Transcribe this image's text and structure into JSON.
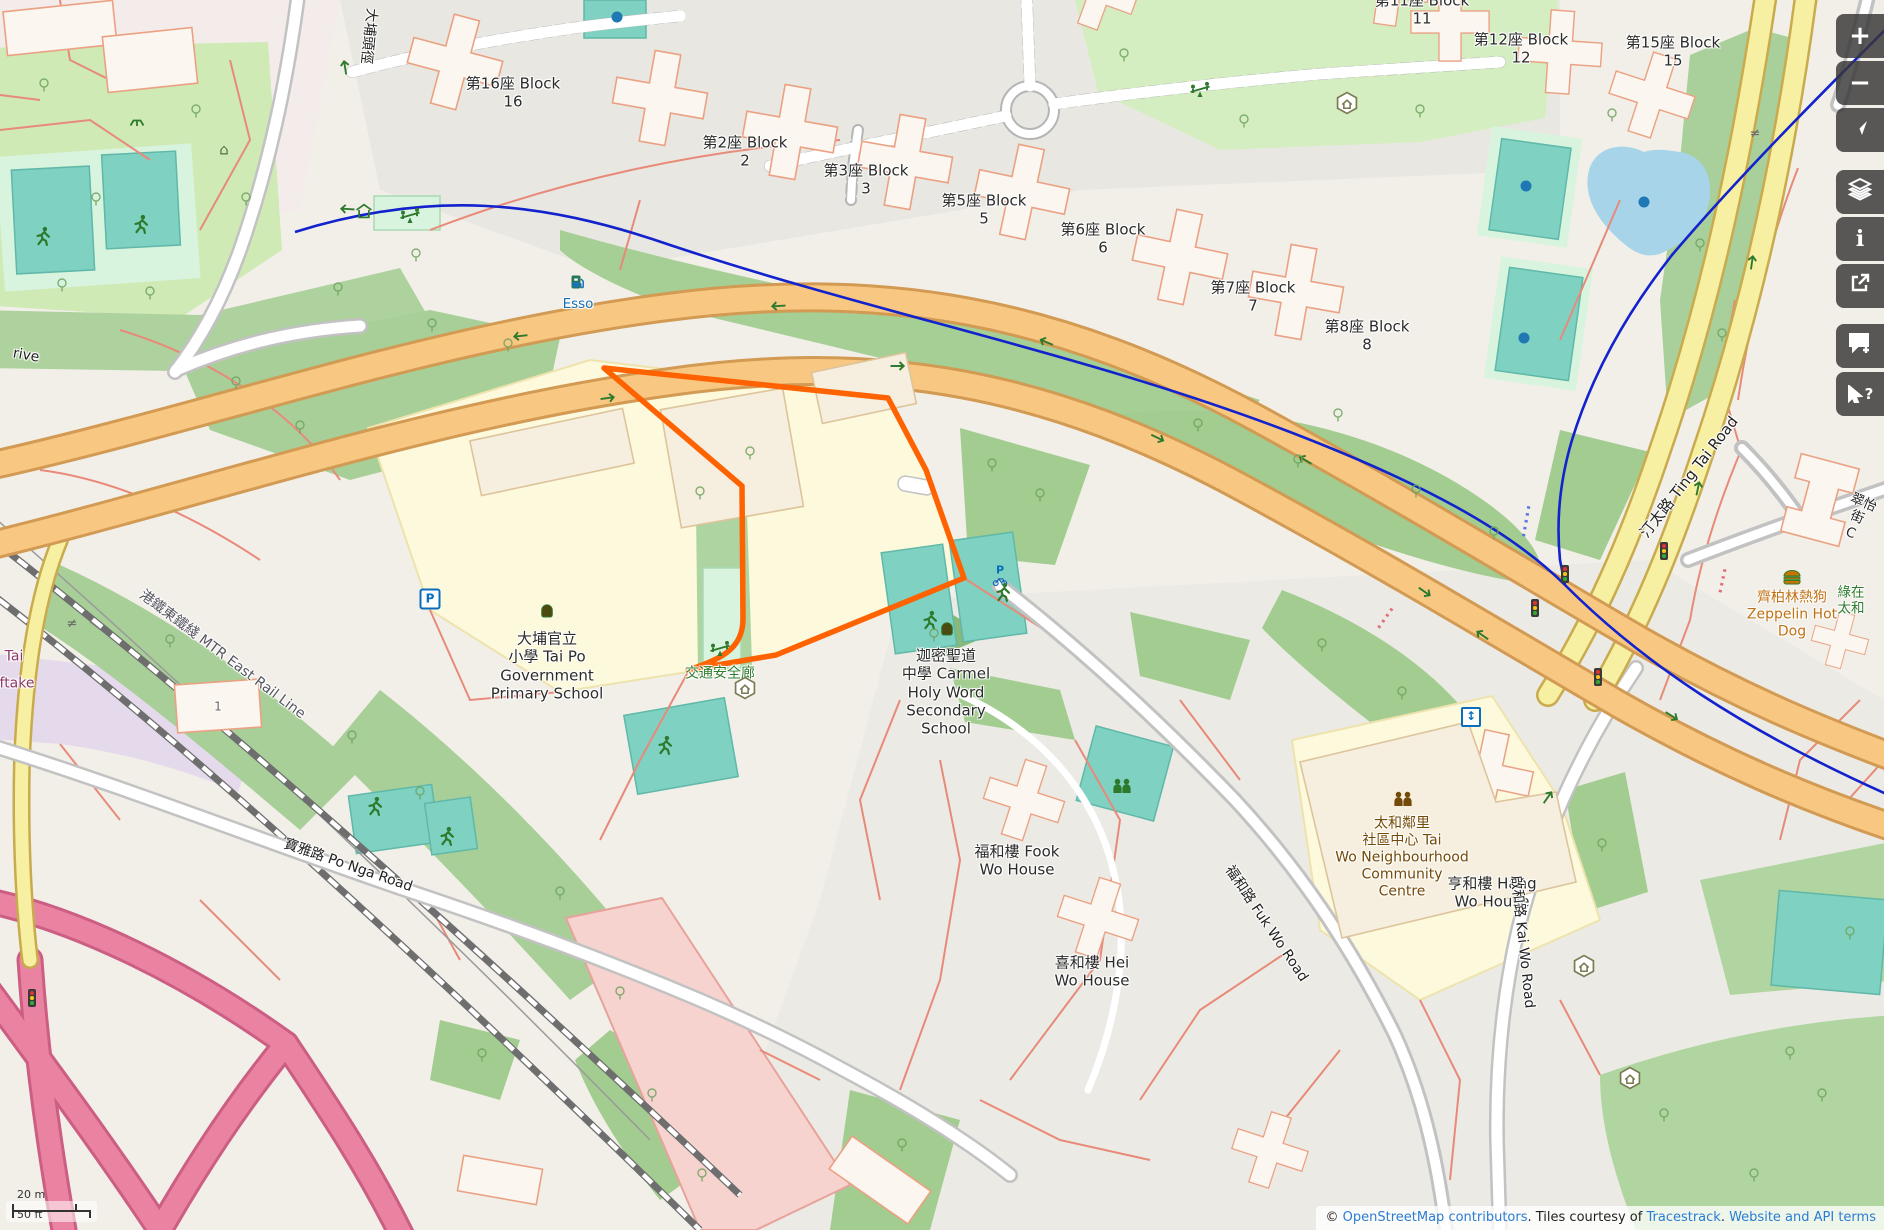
{
  "map": {
    "selection_color": "#ff6200",
    "water_color": "#aad3df",
    "trunk_road_color": "#f8c883",
    "primary_road_color": "#f7efa2"
  },
  "controls": {
    "zoom_in": {
      "label": "+"
    },
    "zoom_out": {
      "label": "−"
    },
    "show_location": {
      "label": ""
    },
    "layers": {
      "label": ""
    },
    "map_info": {
      "label": "i"
    },
    "share": {
      "label": ""
    },
    "add_note": {
      "label": ""
    },
    "query_features": {
      "label": "?"
    }
  },
  "scale_bar": {
    "metric": "20 m",
    "imperial": "50 ft"
  },
  "attribution": {
    "prefix": "© ",
    "osm_link": "OpenStreetMap contributors",
    "middle": ". Tiles courtesy of ",
    "tracestrack_link": "Tracestrack",
    "separator": ". ",
    "terms_link": "Website and API terms"
  },
  "map_labels": [
    {
      "n": "label-block-16",
      "t": "第16座 Block\n16",
      "x": 513,
      "y": 93
    },
    {
      "n": "label-block-2",
      "t": "第2座 Block\n2",
      "x": 745,
      "y": 152
    },
    {
      "n": "label-block-3",
      "t": "第3座 Block\n3",
      "x": 866,
      "y": 180
    },
    {
      "n": "label-block-5",
      "t": "第5座 Block\n5",
      "x": 984,
      "y": 210
    },
    {
      "n": "label-block-6",
      "t": "第6座 Block\n6",
      "x": 1103,
      "y": 239
    },
    {
      "n": "label-block-7",
      "t": "第7座 Block\n7",
      "x": 1253,
      "y": 297
    },
    {
      "n": "label-block-8",
      "t": "第8座 Block\n8",
      "x": 1367,
      "y": 336
    },
    {
      "n": "label-block-11",
      "t": "第11座 Block\n11",
      "x": 1422,
      "y": 10
    },
    {
      "n": "label-block-12",
      "t": "第12座 Block\n12",
      "x": 1521,
      "y": 49
    },
    {
      "n": "label-block-15",
      "t": "第15座 Block\n15",
      "x": 1673,
      "y": 52
    },
    {
      "n": "label-esso",
      "t": "Esso",
      "x": 578,
      "y": 304,
      "c": "#1471b8",
      "s": 13.5
    },
    {
      "n": "label-tai-po-primary-school",
      "t": "大埔官立\n小學 Tai Po\nGovernment\nPrimary School",
      "x": 547,
      "y": 666
    },
    {
      "n": "label-carmel-school",
      "t": "迦密聖道\n中學 Carmel\nHoly Word\nSecondary\nSchool",
      "x": 946,
      "y": 692
    },
    {
      "n": "label-road-safety-corridor",
      "t": "交通安全廊",
      "x": 720,
      "y": 674,
      "c": "#2f7d2f",
      "s": 14
    },
    {
      "n": "label-fook-wo-house",
      "t": "福和樓 Fook\nWo House",
      "x": 1017,
      "y": 861
    },
    {
      "n": "label-community-centre",
      "t": "太和鄰里\n社區中心 Tai\nWo Neighbourhood\nCommunity\nCentre",
      "x": 1402,
      "y": 858,
      "c": "#734a08",
      "s": 14
    },
    {
      "n": "label-zeppelin-hot-dog",
      "t": "齊柏林熱狗\nZeppelin Hot\nDog",
      "x": 1792,
      "y": 615,
      "c": "#c17114",
      "s": 14
    },
    {
      "n": "label-hei-wo-house",
      "t": "喜和樓 Hei\nWo House",
      "x": 1092,
      "y": 972
    },
    {
      "n": "label-hang-wo-house",
      "t": "亨和樓 Hang\nWo House",
      "x": 1492,
      "y": 893
    },
    {
      "n": "label-po-nga-road",
      "t": "寶雅路 Po Nga Road",
      "x": 348,
      "y": 866,
      "r": 19,
      "s": 14,
      "c": "#222"
    },
    {
      "n": "label-ting-tai-road",
      "t": "汀太路 Ting Tai Road",
      "x": 1689,
      "y": 477,
      "r": -52,
      "s": 15,
      "c": "#222"
    },
    {
      "n": "label-fuk-wo-road",
      "t": "福和路 Fuk Wo Road",
      "x": 1266,
      "y": 924,
      "r": 56,
      "s": 14,
      "c": "#222"
    },
    {
      "n": "label-kai-wo-road",
      "t": "啟和路 Kai Wo Road",
      "x": 1522,
      "y": 942,
      "r": 84,
      "s": 14,
      "c": "#222"
    },
    {
      "n": "label-mtr-east-rail-line",
      "t": "港鐵東鐵綫 MTR East Rail Line",
      "x": 222,
      "y": 655,
      "r": 37,
      "s": 14,
      "c": "#55555f"
    },
    {
      "n": "label-tai-po-tau-path",
      "t": "大埔頭徑",
      "x": 368,
      "y": 36,
      "r": 96,
      "s": 14,
      "c": "#222"
    },
    {
      "n": "label-drive-fragment",
      "t": "rive",
      "x": 26,
      "y": 356,
      "r": 10,
      "s": 14,
      "c": "#222"
    },
    {
      "n": "label-tai-fragment",
      "t": "Tai",
      "x": 14,
      "y": 657,
      "c": "#8b3a6a",
      "s": 14
    },
    {
      "n": "label-ftake-fragment",
      "t": "ftake",
      "x": 17,
      "y": 684,
      "c": "#8b3a6a",
      "s": 14
    },
    {
      "n": "label-tsui-yi-street",
      "t": "翠怡街 C",
      "x": 1857,
      "y": 518,
      "r": 23,
      "s": 13.5,
      "c": "#222"
    },
    {
      "n": "label-green-at-tai-wo",
      "t": "綠在太和",
      "x": 1851,
      "y": 601,
      "c": "#2f7d2f",
      "s": 13.5
    },
    {
      "n": "label-building-1",
      "t": "1",
      "x": 218,
      "y": 707,
      "s": 12,
      "c": "#666"
    }
  ],
  "map_icons": [
    {
      "t": "parking",
      "x": 430,
      "y": 599
    },
    {
      "t": "bicycle-parking",
      "x": 1000,
      "y": 576
    },
    {
      "t": "elevator",
      "x": 1471,
      "y": 717
    },
    {
      "t": "fuel",
      "x": 578,
      "y": 282
    },
    {
      "t": "school",
      "x": 547,
      "y": 611
    },
    {
      "t": "school",
      "x": 947,
      "y": 629
    },
    {
      "t": "runner",
      "x": 929,
      "y": 620
    },
    {
      "t": "runner",
      "x": 1002,
      "y": 592
    },
    {
      "t": "runner",
      "x": 664,
      "y": 745
    },
    {
      "t": "runner",
      "x": 42,
      "y": 236
    },
    {
      "t": "runner",
      "x": 140,
      "y": 224
    },
    {
      "t": "runner",
      "x": 374,
      "y": 806
    },
    {
      "t": "runner",
      "x": 446,
      "y": 836
    },
    {
      "t": "pingpong",
      "x": 137,
      "y": 122
    },
    {
      "t": "home",
      "x": 224,
      "y": 150
    },
    {
      "t": "shelter",
      "x": 364,
      "y": 211
    },
    {
      "t": "seesaw",
      "x": 410,
      "y": 216
    },
    {
      "t": "seesaw",
      "x": 1200,
      "y": 90
    },
    {
      "t": "seesaw",
      "x": 720,
      "y": 649
    },
    {
      "t": "hexshelter",
      "x": 1347,
      "y": 103
    },
    {
      "t": "hexshelter",
      "x": 745,
      "y": 688
    },
    {
      "t": "hexshelter",
      "x": 1584,
      "y": 966
    },
    {
      "t": "hexshelter",
      "x": 1630,
      "y": 1078
    },
    {
      "t": "community",
      "x": 1403,
      "y": 799,
      "c": "#734a08"
    },
    {
      "t": "community",
      "x": 1122,
      "y": 786,
      "c": "#2d7a2d"
    },
    {
      "t": "burger",
      "x": 1792,
      "y": 577
    },
    {
      "t": "traffic-light",
      "x": 1565,
      "y": 574
    },
    {
      "t": "traffic-light",
      "x": 1535,
      "y": 608
    },
    {
      "t": "traffic-light",
      "x": 1598,
      "y": 677
    },
    {
      "t": "traffic-light",
      "x": 1664,
      "y": 551
    },
    {
      "t": "traffic-light",
      "x": 32,
      "y": 998
    },
    {
      "t": "fountain",
      "x": 617,
      "y": 17
    },
    {
      "t": "fountain",
      "x": 1526,
      "y": 186
    },
    {
      "t": "fountain",
      "x": 1644,
      "y": 202
    },
    {
      "t": "fountain",
      "x": 1524,
      "y": 338
    },
    {
      "t": "neq",
      "x": 1755,
      "y": 134
    },
    {
      "t": "neq",
      "x": 72,
      "y": 624
    },
    {
      "t": "arrow",
      "x": 520,
      "y": 336,
      "r": 174
    },
    {
      "t": "arrow",
      "x": 778,
      "y": 306,
      "r": 177
    },
    {
      "t": "arrow",
      "x": 1046,
      "y": 342,
      "r": 203
    },
    {
      "t": "arrow",
      "x": 1305,
      "y": 460,
      "r": 211
    },
    {
      "t": "arrow",
      "x": 1482,
      "y": 635,
      "r": 215
    },
    {
      "t": "arrow",
      "x": 608,
      "y": 398,
      "r": -8
    },
    {
      "t": "arrow",
      "x": 898,
      "y": 366,
      "r": 0
    },
    {
      "t": "arrow",
      "x": 1158,
      "y": 438,
      "r": 26
    },
    {
      "t": "arrow",
      "x": 1425,
      "y": 592,
      "r": 35
    },
    {
      "t": "arrow",
      "x": 1672,
      "y": 716,
      "r": 32
    },
    {
      "t": "arrow",
      "x": 1698,
      "y": 488,
      "r": -78
    },
    {
      "t": "arrow",
      "x": 1752,
      "y": 262,
      "r": -82
    },
    {
      "t": "arrow",
      "x": 1548,
      "y": 797,
      "r": -55
    },
    {
      "t": "arrow",
      "x": 347,
      "y": 209,
      "r": 183
    },
    {
      "t": "arrow",
      "x": 345,
      "y": 67,
      "r": -99
    },
    {
      "t": "reddots",
      "x": 1384,
      "y": 620,
      "r": 35
    },
    {
      "t": "reddots",
      "x": 1722,
      "y": 583,
      "r": 12
    },
    {
      "t": "bluedots",
      "x": 1526,
      "y": 522,
      "r": 10
    }
  ],
  "trees": [
    [
      44,
      92
    ],
    [
      96,
      206
    ],
    [
      196,
      118
    ],
    [
      246,
      206
    ],
    [
      62,
      292
    ],
    [
      150,
      300
    ],
    [
      338,
      296
    ],
    [
      416,
      262
    ],
    [
      236,
      390
    ],
    [
      300,
      434
    ],
    [
      432,
      332
    ],
    [
      508,
      352
    ],
    [
      992,
      472
    ],
    [
      1040,
      502
    ],
    [
      934,
      642
    ],
    [
      1198,
      432
    ],
    [
      1298,
      468
    ],
    [
      1416,
      498
    ],
    [
      1494,
      540
    ],
    [
      1338,
      422
    ],
    [
      1124,
      62
    ],
    [
      1244,
      128
    ],
    [
      1420,
      118
    ],
    [
      1612,
      122
    ],
    [
      1700,
      252
    ],
    [
      1722,
      342
    ],
    [
      1322,
      652
    ],
    [
      1402,
      700
    ],
    [
      1602,
      852
    ],
    [
      1664,
      1122
    ],
    [
      1754,
      1182
    ],
    [
      1822,
      1102
    ],
    [
      652,
      1102
    ],
    [
      702,
      1182
    ],
    [
      902,
      1152
    ],
    [
      482,
      1062
    ],
    [
      352,
      744
    ],
    [
      420,
      800
    ],
    [
      170,
      648
    ],
    [
      560,
      900
    ],
    [
      620,
      1000
    ],
    [
      1850,
      940
    ],
    [
      1790,
      1060
    ],
    [
      750,
      460
    ],
    [
      700,
      500
    ]
  ]
}
